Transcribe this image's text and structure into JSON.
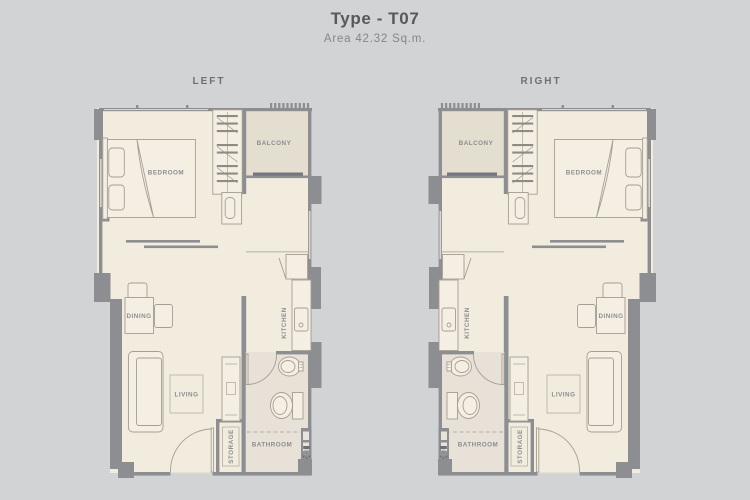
{
  "page": {
    "title": "Type - T07",
    "subtitle": "Area 42.32 Sq.m."
  },
  "palette": {
    "background": "#d2d3d5",
    "wall": "#8c8e92",
    "floor": "#f2ecdf",
    "balcony_floor": "#e4ded1",
    "bathroom_floor": "#e7e1d7",
    "furniture_line": "#a49e93",
    "title_text": "#57585b",
    "subtitle_text": "#84868a",
    "side_label_text": "#6f7074",
    "room_label_text": "#8c8d91"
  },
  "plans": [
    {
      "id": "left",
      "label": "LEFT",
      "rooms": {
        "bedroom": "BEDROOM",
        "balcony": "BALCONY",
        "dining": "DINING",
        "living": "LIVING",
        "kitchen": "KITCHEN",
        "storage": "STORAGE",
        "bathroom": "BATHROOM"
      }
    },
    {
      "id": "right",
      "label": "RIGHT",
      "rooms": {
        "bedroom": "BEDROOM",
        "balcony": "BALCONY",
        "dining": "DINING",
        "living": "LIVING",
        "kitchen": "KITCHEN",
        "storage": "STORAGE",
        "bathroom": "BATHROOM"
      }
    }
  ]
}
